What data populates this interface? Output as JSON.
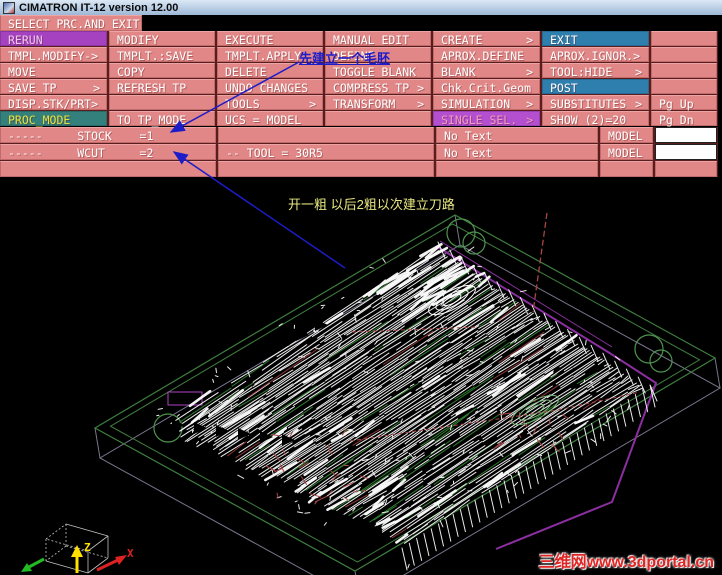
{
  "window": {
    "title": "CIMATRON IT-12 version 12.00"
  },
  "menu": {
    "select_label": "SELECT PRC.AND EXIT",
    "arrow_char": ">",
    "rows": [
      {
        "cells": [
          {
            "label": "RERUN",
            "variant": "purple"
          },
          {
            "label": "MODIFY"
          },
          {
            "label": "EXECUTE"
          },
          {
            "label": "MANUAL EDIT"
          },
          {
            "label": "CREATE",
            "arrow": true
          },
          {
            "label": "EXIT",
            "variant": "blue"
          },
          {
            "label": ""
          }
        ]
      },
      {
        "cells": [
          {
            "label": "TMPL.MODIFY->"
          },
          {
            "label": "TMPLT.:SAVE"
          },
          {
            "label": "TMPLT.APPLY"
          },
          {
            "label": "DEFINE"
          },
          {
            "label": "APROX.DEFINE"
          },
          {
            "label": "APROX.IGNOR.>"
          },
          {
            "label": ""
          }
        ]
      },
      {
        "cells": [
          {
            "label": "MOVE"
          },
          {
            "label": "COPY"
          },
          {
            "label": "DELETE"
          },
          {
            "label": "TOGGLE BLANK"
          },
          {
            "label": "BLANK",
            "arrow": true
          },
          {
            "label": "TOOL:HIDE",
            "arrow": true
          },
          {
            "label": ""
          }
        ]
      },
      {
        "cells": [
          {
            "label": "SAVE TP",
            "arrow": true
          },
          {
            "label": "REFRESH TP"
          },
          {
            "label": "UNDO CHANGES"
          },
          {
            "label": "COMPRESS TP",
            "arrow": true
          },
          {
            "label": "Chk.Crit.Geom"
          },
          {
            "label": "POST",
            "variant": "blue"
          },
          {
            "label": ""
          }
        ]
      },
      {
        "cells": [
          {
            "label": "DISP.STK/PRT>"
          },
          {
            "label": ""
          },
          {
            "label": "TOOLS",
            "arrow": true
          },
          {
            "label": "TRANSFORM",
            "arrow": true
          },
          {
            "label": "SIMULATION",
            "arrow": true
          },
          {
            "label": "SUBSTITUTES",
            "arrow": true
          },
          {
            "label": "Pg Up"
          }
        ]
      },
      {
        "cells": [
          {
            "label": "PROC_MODE",
            "variant": "teal"
          },
          {
            "label": "TO TP_MODE"
          },
          {
            "label": "UCS = MODEL"
          },
          {
            "label": ""
          },
          {
            "label": "SINGLE SEL.",
            "variant": "violet",
            "arrow": true
          },
          {
            "label": "SHOW (2)=20"
          },
          {
            "label": "Pg Dn"
          }
        ]
      }
    ]
  },
  "status": {
    "rows": [
      {
        "cells": [
          {
            "text": "-----     STOCK    =1"
          },
          {
            "text": ""
          },
          {
            "text": "No Text"
          },
          {
            "text": "MODEL"
          },
          {
            "text": "",
            "box": "white"
          }
        ]
      },
      {
        "cells": [
          {
            "text": "-----     WCUT     =2"
          },
          {
            "text": "-- TOOL = 30R5"
          },
          {
            "text": "No Text"
          },
          {
            "text": "MODEL"
          },
          {
            "text": "",
            "box": "white"
          }
        ]
      },
      {
        "cells": [
          {
            "text": ""
          },
          {
            "text": ""
          },
          {
            "text": ""
          },
          {
            "text": ""
          },
          {
            "text": "",
            "box": "pink"
          }
        ]
      }
    ]
  },
  "annotations": {
    "blue_note": "先建立一个毛胚",
    "yellow_note": "开一粗 以后2粗以次建立刀路",
    "watermark": "三维网www.3dportal.cn"
  },
  "scene": {
    "background": "#000000",
    "part_quad": {
      "L": [
        150,
        432
      ],
      "T": [
        438,
        242
      ],
      "B": [
        402,
        548
      ],
      "R": [
        650,
        385
      ]
    },
    "stock_frame": {
      "outer": [
        [
          455,
          215
        ],
        [
          715,
          358
        ],
        [
          355,
          571
        ],
        [
          95,
          428
        ]
      ],
      "inner_scale": 0.95,
      "drop": [
        5,
        30
      ],
      "color": "#3f7f3f",
      "lower_color": "#77778c"
    },
    "circles": [
      [
        461,
        233,
        14
      ],
      [
        474,
        243,
        11
      ],
      [
        649,
        349,
        14
      ],
      [
        661,
        361,
        11
      ],
      [
        168,
        428,
        14
      ]
    ],
    "magenta": {
      "color": "#8b2fa0",
      "rect_color": "#b044c4",
      "path": [
        [
          436,
          246
        ],
        [
          608,
          352
        ],
        [
          656,
          383
        ],
        [
          612,
          502
        ],
        [
          496,
          549
        ]
      ],
      "edge2": [
        [
          440,
          241
        ],
        [
          612,
          347
        ]
      ],
      "rect": [
        168,
        392,
        34,
        13
      ]
    },
    "red": {
      "color": "#a84545",
      "vline": [
        [
          547,
          213
        ],
        [
          533,
          312
        ]
      ],
      "dash1": [
        [
          350,
          441
        ],
        [
          558,
          410
        ],
        [
          640,
          392
        ]
      ],
      "dash2": [
        [
          352,
          332
        ],
        [
          478,
          327
        ]
      ],
      "clusters": [
        [
          320,
          468,
          26,
          48,
          34
        ],
        [
          525,
          432,
          14,
          40,
          24
        ]
      ]
    },
    "hatch": {
      "rows": 100,
      "white": "#ffffff",
      "green": "#2f7a2f",
      "darkred": "#8b3535",
      "specks": 150,
      "thick": 70
    },
    "teeth": {
      "rows": [
        [
          172,
          425,
          22,
          3,
          6
        ],
        [
          258,
          355,
          19,
          -10,
          4
        ]
      ]
    },
    "contours": {
      "white_center": [
        452,
        300
      ],
      "green_center": [
        535,
        410
      ],
      "green_color": "#79b879",
      "tilt": -28
    },
    "axis": {
      "x_label": "X",
      "z_label": "Z",
      "x_color": "#dd2222",
      "z_color": "#ffe000",
      "y_color": "#22bb22",
      "box_color": "#c0c0c0"
    },
    "arrows": {
      "color": "#1c1cc8",
      "a1": [
        [
          299,
          62
        ],
        [
          171,
          132
        ]
      ],
      "a2": [
        [
          345,
          268
        ],
        [
          174,
          152
        ]
      ]
    }
  }
}
